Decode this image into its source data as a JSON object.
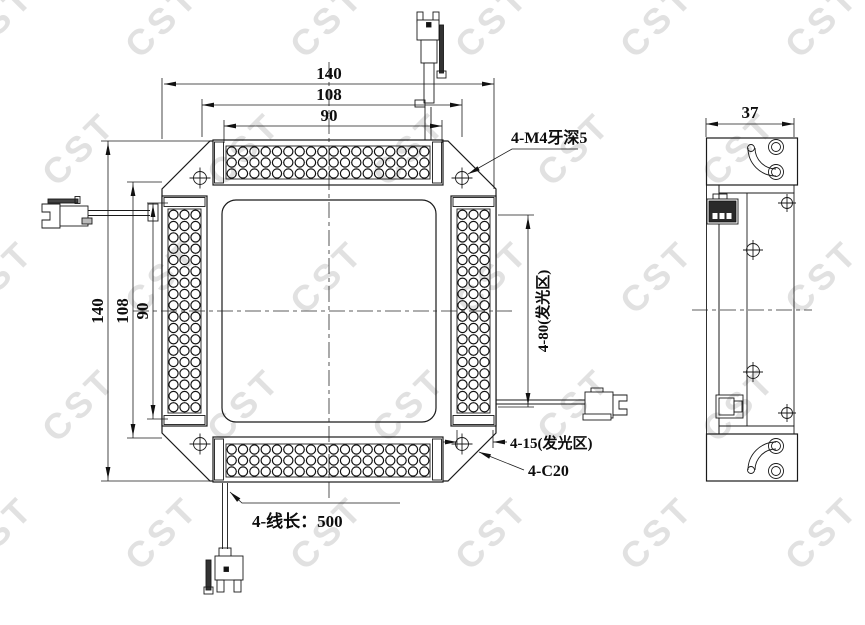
{
  "drawing": {
    "watermark_text": "CST",
    "front_view": {
      "dim_overall_width": "140",
      "dim_mount_width": "108",
      "dim_window_width": "90",
      "dim_overall_height": "140",
      "dim_mount_height": "108",
      "dim_window_height": "90",
      "label_thread": "4-M4牙深5",
      "label_emit_length": "4-80(发光区)",
      "label_emit_width": "4-15(发光区)",
      "label_chamfer": "4-C20",
      "label_cable": "4-线长：500"
    },
    "side_view": {
      "dim_width": "37"
    }
  }
}
